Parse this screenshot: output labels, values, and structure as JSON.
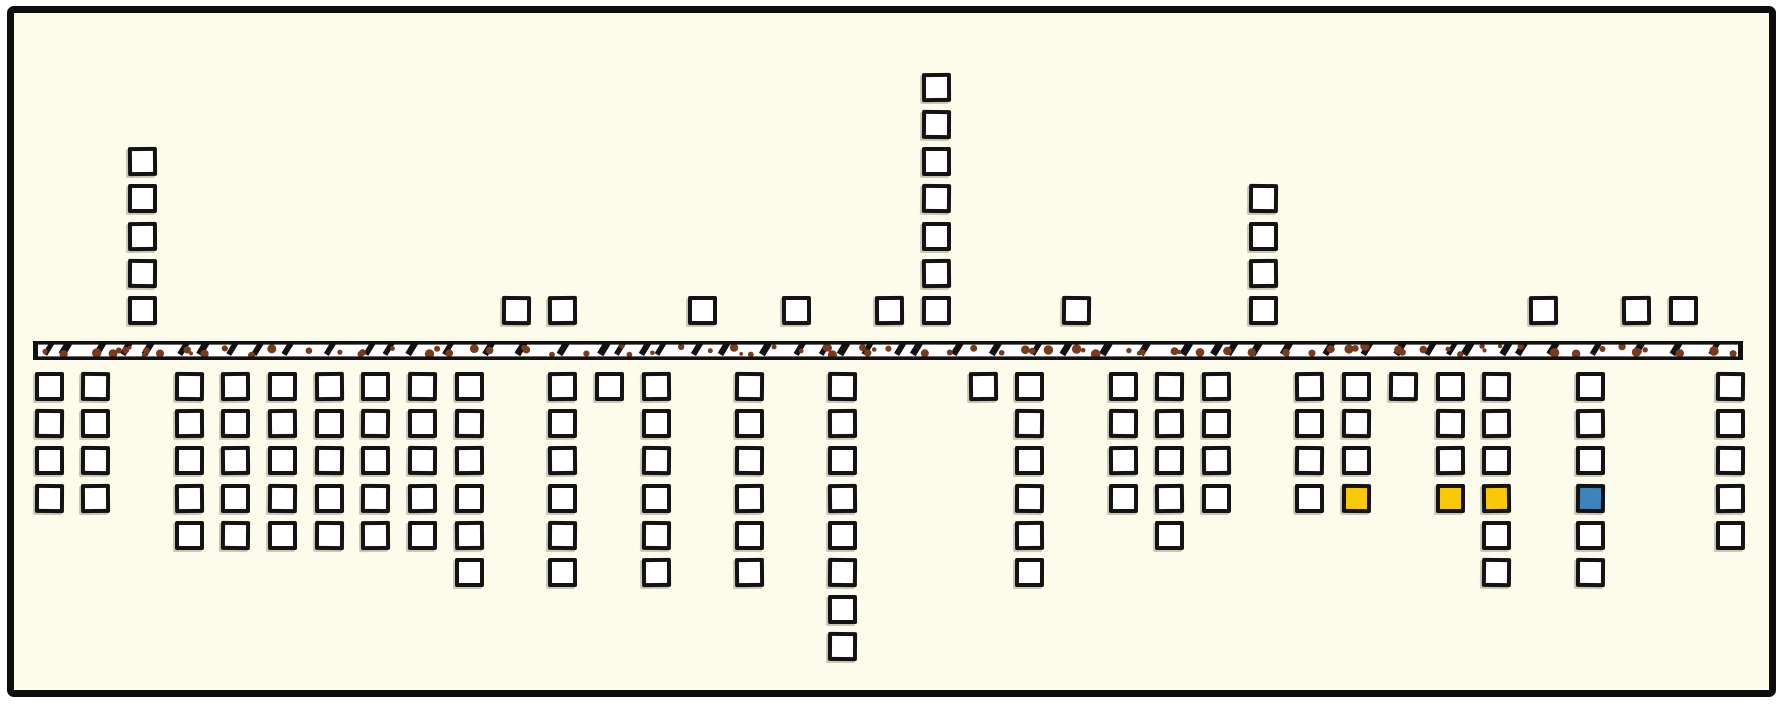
{
  "chart_data": {
    "type": "bar",
    "variant": "diverging-square-pictogram",
    "orientation": "horizontal axis band with square stacks above and below",
    "title": "",
    "xlabel": "",
    "ylabel": "",
    "grid": false,
    "legend": "none",
    "slots": 37,
    "categories": [
      0,
      1,
      2,
      3,
      4,
      5,
      6,
      7,
      8,
      9,
      10,
      11,
      12,
      13,
      14,
      15,
      16,
      17,
      18,
      19,
      20,
      21,
      22,
      23,
      24,
      25,
      26,
      27,
      28,
      29,
      30,
      31,
      32,
      33,
      34,
      35,
      36
    ],
    "series": [
      {
        "name": "above-axis-squares",
        "values": [
          0,
          0,
          5,
          0,
          0,
          0,
          0,
          0,
          0,
          0,
          1,
          1,
          0,
          0,
          1,
          0,
          1,
          0,
          1,
          7,
          0,
          0,
          1,
          0,
          0,
          0,
          4,
          0,
          0,
          0,
          0,
          0,
          1,
          0,
          1,
          1,
          0
        ]
      },
      {
        "name": "below-axis-squares",
        "values": [
          4,
          4,
          0,
          5,
          5,
          5,
          5,
          5,
          5,
          6,
          0,
          6,
          1,
          6,
          0,
          6,
          0,
          8,
          0,
          0,
          1,
          6,
          0,
          4,
          5,
          4,
          0,
          4,
          4,
          1,
          4,
          6,
          0,
          6,
          0,
          0,
          5
        ]
      }
    ],
    "highlights": [
      {
        "slot": 28,
        "side": "below",
        "row": 4,
        "color_name": "yellow",
        "color": "#F9C907"
      },
      {
        "slot": 30,
        "side": "below",
        "row": 4,
        "color_name": "yellow",
        "color": "#F9C907"
      },
      {
        "slot": 31,
        "side": "below",
        "row": 4,
        "color_name": "yellow",
        "color": "#F9C907"
      },
      {
        "slot": 33,
        "side": "below",
        "row": 4,
        "color_name": "blue",
        "color": "#3E82BE"
      }
    ],
    "totals": {
      "above_squares": 25,
      "below_squares": 121,
      "highlighted_squares": 4
    },
    "axis_band": {
      "description": "hand-drawn textured strip with black top and bottom edges, scattered brown dots and slanted black tick marks",
      "fill": "#ffffff",
      "edge_color": "#111111",
      "dot_color": "#7A3A1D",
      "tick_color": "#111111"
    },
    "colors": {
      "background": "#FDFBEC",
      "frame_ink": "#0d0d0d",
      "square_fill": "#ffffff",
      "square_ink": "#131313",
      "highlight_yellow": "#F9C907",
      "highlight_blue": "#3E82BE",
      "band_dot_brown": "#7A3A1D"
    }
  }
}
